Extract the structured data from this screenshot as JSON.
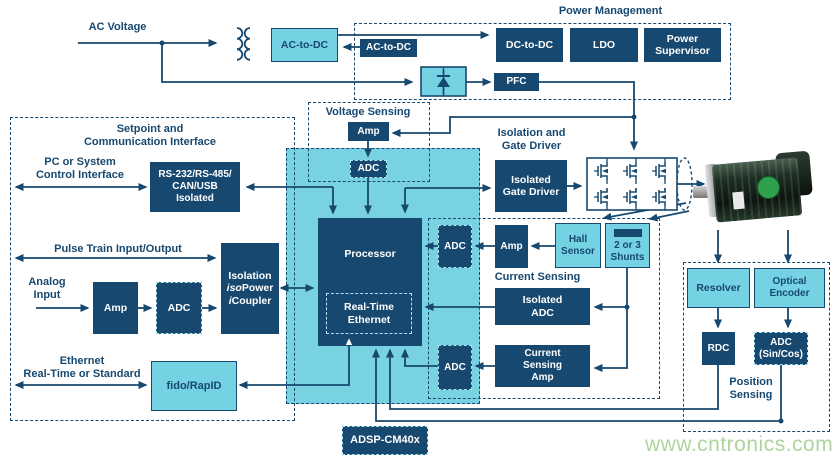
{
  "labels": {
    "ac_voltage": "AC Voltage",
    "power_management": "Power Management",
    "voltage_sensing": "Voltage Sensing",
    "setpoint": "Setpoint and\nCommunication Interface",
    "pc_interface": "PC or System\nControl Interface",
    "pulse_train": "Pulse Train Input/Output",
    "analog_input": "Analog\nInput",
    "ethernet": "Ethernet\nReal-Time or Standard",
    "isolation_gate_driver": "Isolation and\nGate Driver",
    "current_sensing": "Current Sensing",
    "position_sensing": "Position\nSensing"
  },
  "blocks": {
    "ac_to_dc_primary": "AC-to-DC",
    "ac_to_dc_aux": "AC-to-DC",
    "dc_to_dc": "DC-to-DC",
    "ldo": "LDO",
    "power_supervisor": "Power\nSupervisor",
    "pfc": "PFC",
    "vs_amp": "Amp",
    "vs_adc": "ADC",
    "rs232": "RS-232/RS-485/\nCAN/USB\nIsolated",
    "processor": "Processor",
    "rt_ethernet": "Real-Time\nEthernet",
    "isolated_gate_driver": "Isolated\nGate Driver",
    "analog_amp": "Amp",
    "analog_adc": "ADC",
    "icoupler": {
      "l1": "Isolation",
      "iso": "iso",
      "power": "Power",
      "i": "i",
      "coupler": "Coupler"
    },
    "fido": "fido/RapID",
    "adsp": "ADSP-CM40x",
    "hall_adc": "ADC",
    "hall_amp": "Amp",
    "hall_sensor": "Hall\nSensor",
    "shunts": "2 or 3\nShunts",
    "isolated_adc": "Isolated\nADC",
    "cs_amp": "Current\nSensing\nAmp",
    "cs_adc": "ADC",
    "resolver": "Resolver",
    "optical_encoder": "Optical\nEncoder",
    "rdc": "RDC",
    "adc_sincos": "ADC\n(Sin/Cos)"
  },
  "watermark": "www.cntronics.com",
  "colors": {
    "navy": "#17486f",
    "cyan": "#74d2e3",
    "cyan-panel": "#79d2e2",
    "dash-accent": "#a9e6f0",
    "watermark-green": "#abd69b",
    "motor-green": "#2fa14e"
  }
}
